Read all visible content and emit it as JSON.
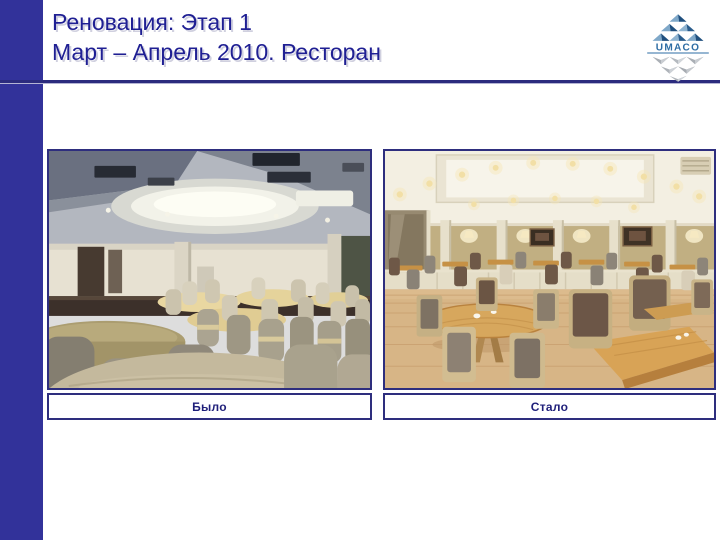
{
  "slide": {
    "title": {
      "line1": "Реновация: Этап 1",
      "line2": "Март – Апрель 2010. Ресторан"
    },
    "logo": {
      "brand": "UMACO"
    },
    "comparison": {
      "before_caption": "Было",
      "after_caption": "Стало"
    },
    "colors": {
      "accent_bar": "#32329A",
      "title_text": "#1F1F93",
      "title_rule": "#2B2B7E",
      "caption_text": "#1F1F7A",
      "caption_border": "#2E2E7E",
      "background": "#FFFFFF",
      "logo_blue": "#2E6DA4",
      "logo_gray": "#AAAFB5"
    }
  }
}
